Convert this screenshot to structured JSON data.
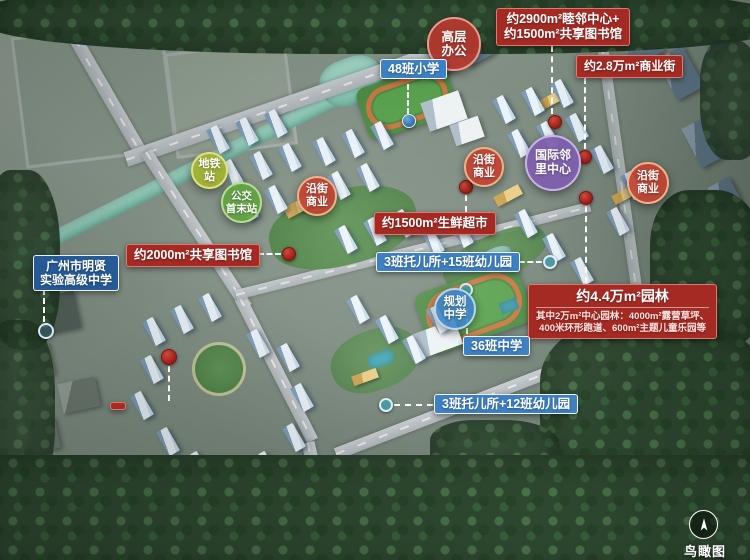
{
  "annotations": {
    "neighbor_center": {
      "line1": "约2900m²睦邻中心+",
      "line2": "约1500m²共享图书馆"
    },
    "commercial_street": "约2.8万m²商业街",
    "office_tower": {
      "line1": "高层",
      "line2": "办公"
    },
    "primary_school": "48班小学",
    "metro_station": {
      "line1": "地铁",
      "line2": "站"
    },
    "bus_terminal": {
      "line1": "公交",
      "line2": "首末站"
    },
    "street_retail": {
      "line1": "沿街",
      "line2": "商业"
    },
    "intl_neighborhood_center": {
      "line1": "国际邻",
      "line2": "里中心"
    },
    "fresh_market_north": "约1500m²生鲜超市",
    "shared_library_2000": "约2000m²共享图书馆",
    "nursery_15": "3班托儿所+15班幼儿园",
    "mingxian_school": {
      "line1": "广州市明贤",
      "line2": "实验高级中学"
    },
    "planned_middle_school": {
      "line1": "规划",
      "line2": "中学"
    },
    "garden": {
      "title": "约4.4万m²园林",
      "detail_line1": "其中2万m²中心园林：4000m²露营草坪、",
      "detail_line2": "400米环形跑道、600m²主题儿童乐园等"
    },
    "middle_school_36": "36班中学",
    "nursery_12": "3班托儿所+12班幼儿园",
    "view_caption": "鸟瞰图"
  },
  "colors": {
    "red_label": "#a52a23",
    "blue_label": "#3d80c4",
    "navy_label": "#255a96",
    "red_circle": "#b5382e",
    "olive_circle": "#a3b132",
    "green_circle": "#61a440",
    "orange_circle": "#c14334",
    "purple_circle": "#7e5fae",
    "blue_circle": "#3e84c6",
    "teal_marker": "#3ba7c4",
    "red_marker": "#a8231d",
    "blue_marker": "#2f6ca8"
  }
}
